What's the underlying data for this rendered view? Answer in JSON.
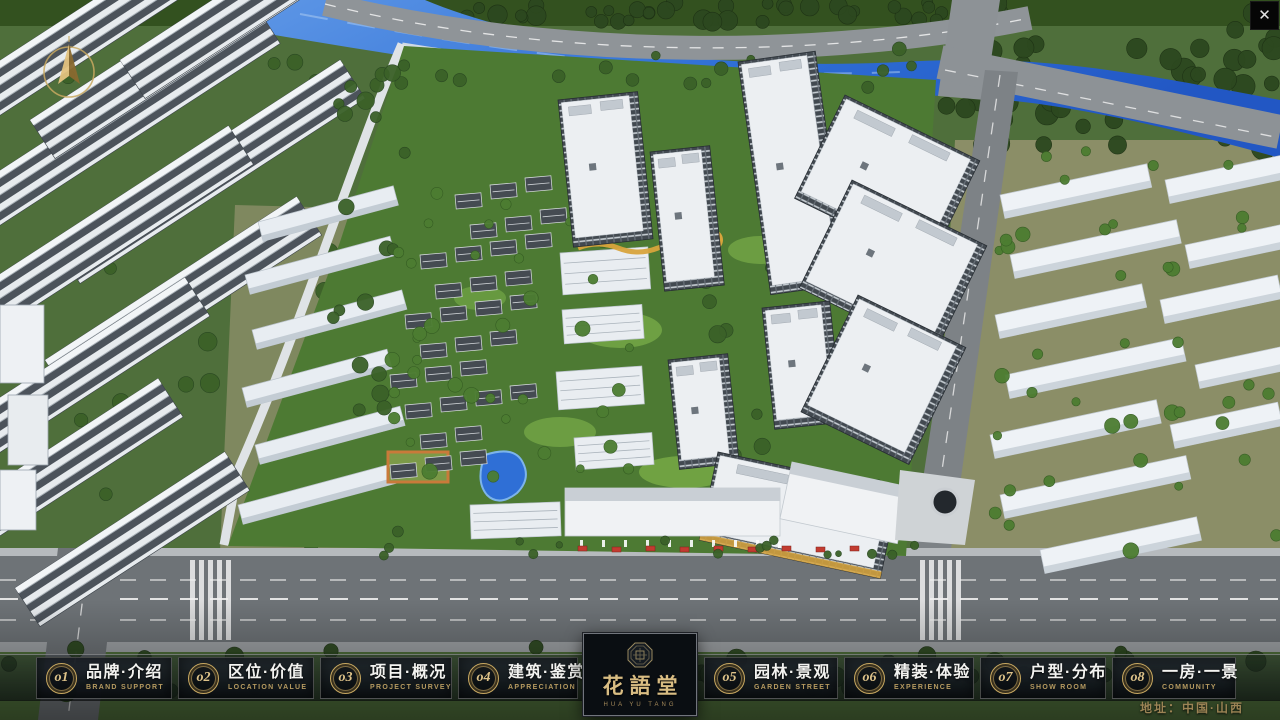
{
  "window": {
    "close_label": "✕"
  },
  "nav": {
    "items": [
      {
        "num": "o1",
        "title": "品牌·介绍",
        "subtitle": "BRAND SUPPORT"
      },
      {
        "num": "o2",
        "title": "区位·价值",
        "subtitle": "LOCATION VALUE"
      },
      {
        "num": "o3",
        "title": "项目·概况",
        "subtitle": "PROJECT SURVEY"
      },
      {
        "num": "o4",
        "title": "建筑·鉴赏",
        "subtitle": "APPRECIATION"
      },
      {
        "num": "o5",
        "title": "园林·景观",
        "subtitle": "GARDEN STREET"
      },
      {
        "num": "o6",
        "title": "精装·体验",
        "subtitle": "EXPERIENCE"
      },
      {
        "num": "o7",
        "title": "户型·分布",
        "subtitle": "SHOW ROOM"
      },
      {
        "num": "o8",
        "title": "一房·一景",
        "subtitle": "COMMUNITY"
      }
    ]
  },
  "logo": {
    "name": "花語堂",
    "caption": "HUA YU TANG"
  },
  "footer": {
    "address_label": "地址：中国·山西"
  },
  "scene": {
    "type": "3d-aerial-masterplan-render",
    "compass": "north-arrow"
  },
  "colors": {
    "gold": "#c9a961",
    "bar_bg": "#0c1218",
    "river_blue": "#2f6fd6",
    "foliage_green": "#3d5a2b"
  }
}
